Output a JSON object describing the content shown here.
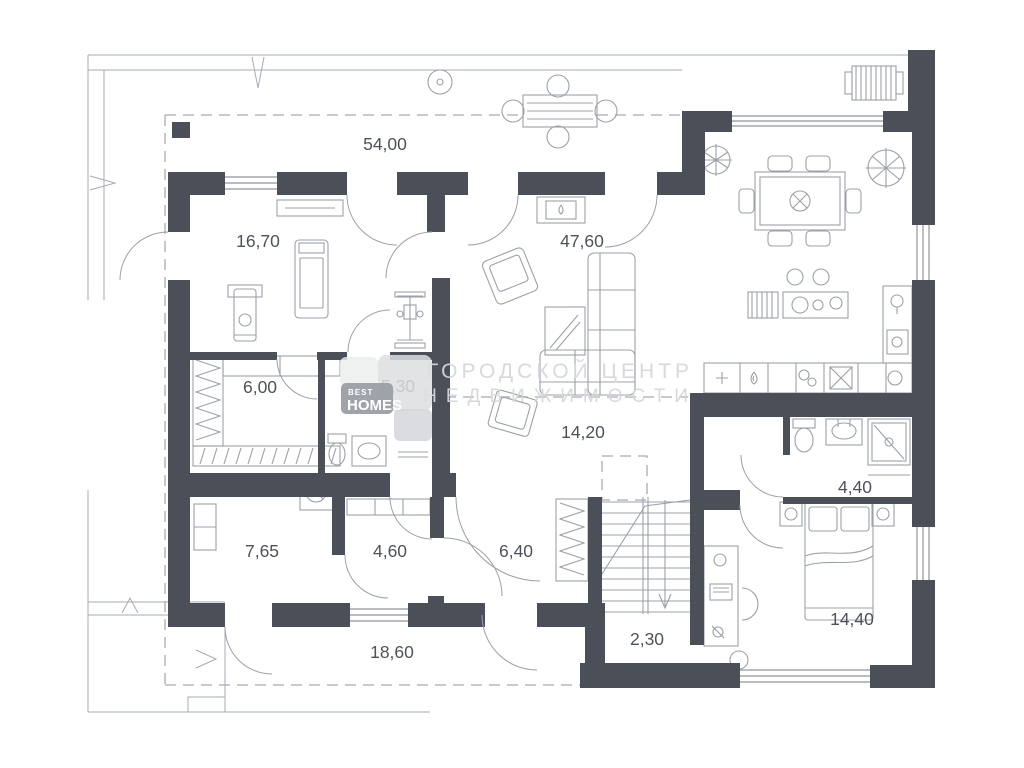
{
  "plan": {
    "rooms": [
      {
        "id": "terrace-top",
        "area": "54,00"
      },
      {
        "id": "gym",
        "area": "16,70"
      },
      {
        "id": "living-room",
        "area": "47,60"
      },
      {
        "id": "sauna-room",
        "area": "6,00"
      },
      {
        "id": "bathroom-small",
        "area": "5,30"
      },
      {
        "id": "hallway",
        "area": "14,20"
      },
      {
        "id": "bathroom-right",
        "area": "4,40"
      },
      {
        "id": "room-bottom-left",
        "area": "7,65"
      },
      {
        "id": "laundry",
        "area": "4,60"
      },
      {
        "id": "entry-hall",
        "area": "6,40"
      },
      {
        "id": "stairs-landing",
        "area": "2,30"
      },
      {
        "id": "terrace-bottom",
        "area": "18,60"
      },
      {
        "id": "bedroom",
        "area": "14,40"
      }
    ]
  },
  "watermark": {
    "line1": "ГОРОДСКОЙ ЦЕНТР",
    "line2": "НЕДВИЖИМОСТИ"
  },
  "logo": {
    "top": "BEST",
    "bottom": "HOMES"
  },
  "colors": {
    "wall": "#4a4f58",
    "line": "#a6abb3",
    "furniture": "#9ba1a9",
    "window": "#8f959e",
    "label": "#4d525c",
    "watermark": "#d5d7db",
    "logo-badge": "#9ba0a8",
    "logo-tile": "#dcdee1"
  }
}
